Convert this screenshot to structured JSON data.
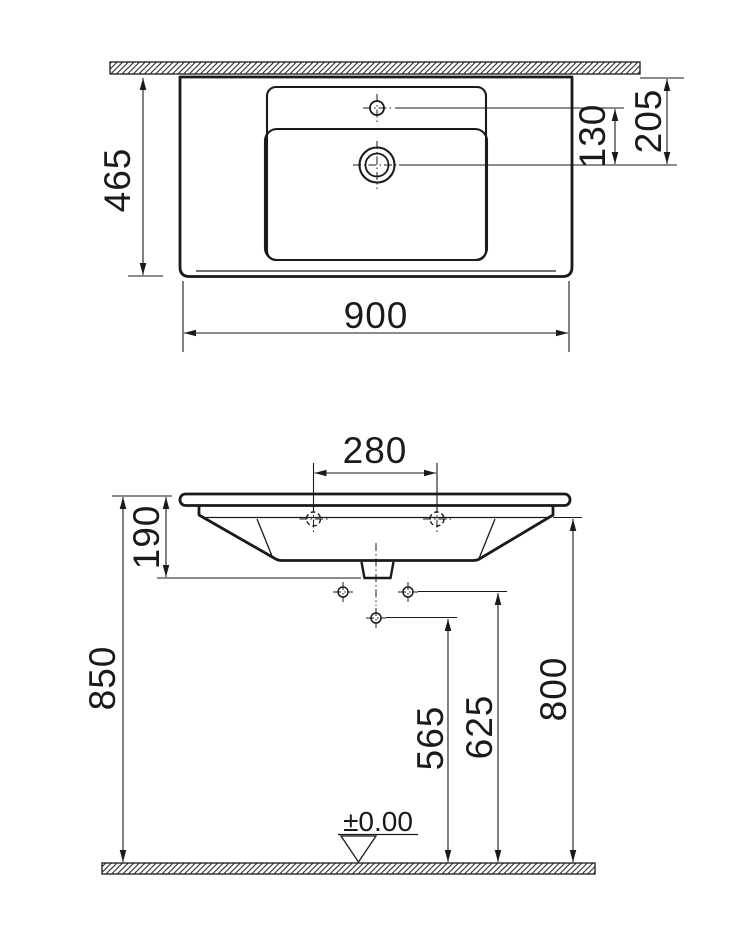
{
  "drawing": {
    "kind": "washbasin-installation-technical-drawing",
    "views": {
      "plan": "top view against wall",
      "elevation": "front view above floor"
    }
  },
  "dims": {
    "top_width": "900",
    "top_depth": "465",
    "tap_to_drain": "130",
    "wall_to_drain": "205",
    "hole_spacing": "280",
    "rim_to_outlet": "190",
    "bracket_spacing": "150",
    "h_565": "565",
    "h_625": "625",
    "h_800": "800",
    "h_850": "850",
    "floor_level": "±0.00"
  }
}
